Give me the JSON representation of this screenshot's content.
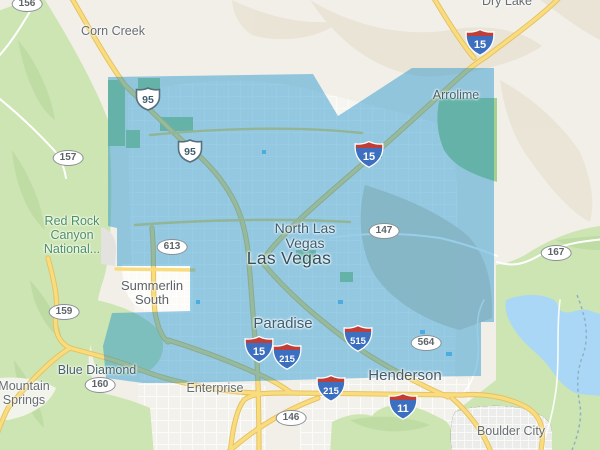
{
  "app": "map-viewer",
  "region_name": "Las Vegas metropolitan coverage area",
  "labels": {
    "corn_creek": "Corn Creek",
    "dry_lake": "Dry Lake",
    "arrolime": "Arrolime",
    "north_las_vegas_l1": "North Las",
    "north_las_vegas_l2": "Vegas",
    "las_vegas": "Las Vegas",
    "red_rock_l1": "Red Rock",
    "red_rock_l2": "Canyon",
    "red_rock_l3": "National...",
    "summerlin_l1": "Summerlin",
    "summerlin_l2": "South",
    "paradise": "Paradise",
    "blue_diamond": "Blue Diamond",
    "mountain_springs_l1": "Mountain",
    "mountain_springs_l2": "Springs",
    "enterprise": "Enterprise",
    "henderson": "Henderson",
    "boulder_city": "Boulder City"
  },
  "shields": [
    {
      "type": "us-route",
      "num": "95"
    },
    {
      "type": "us-route",
      "num": "95"
    },
    {
      "type": "state-route",
      "num": "156"
    },
    {
      "type": "state-route",
      "num": "157"
    },
    {
      "type": "state-route",
      "num": "613"
    },
    {
      "type": "state-route",
      "num": "159"
    },
    {
      "type": "state-route",
      "num": "160"
    },
    {
      "type": "state-route",
      "num": "147"
    },
    {
      "type": "state-route",
      "num": "167"
    },
    {
      "type": "state-route",
      "num": "146"
    },
    {
      "type": "state-route",
      "num": "564"
    },
    {
      "type": "interstate",
      "num": "15"
    },
    {
      "type": "interstate",
      "num": "15"
    },
    {
      "type": "interstate",
      "num": "15"
    },
    {
      "type": "interstate",
      "num": "215"
    },
    {
      "type": "interstate",
      "num": "515"
    },
    {
      "type": "interstate",
      "num": "215"
    },
    {
      "type": "interstate",
      "num": "11"
    }
  ],
  "colors": {
    "coverage_overlay": "#0d8bca",
    "coverage_overlay_opacity": "0.42",
    "water": "#a9d7f5",
    "park_green": "#cde5b2",
    "desert": "#f2efe9",
    "road_yellow": "#f8dc7e",
    "interstate_blue": "#3d6fc0",
    "interstate_red": "#bf3f38"
  }
}
